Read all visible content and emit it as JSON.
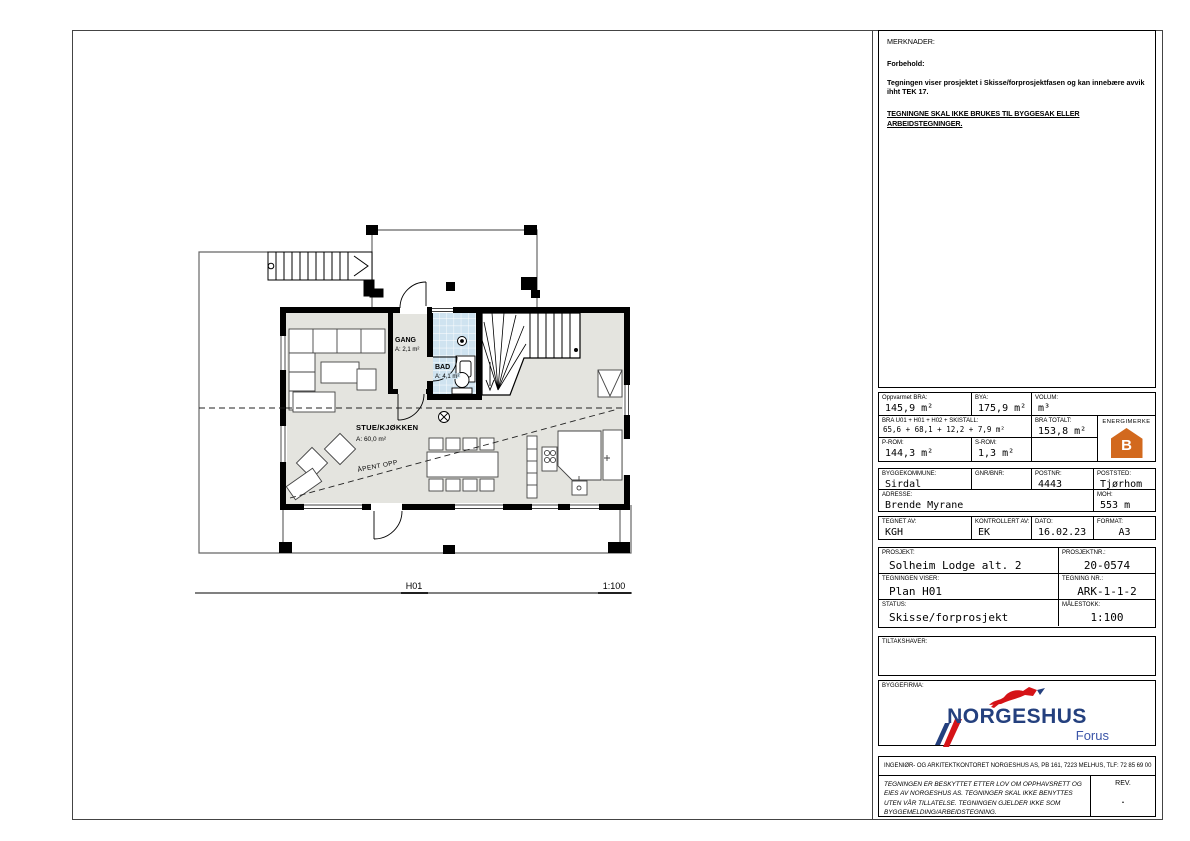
{
  "sheet": {
    "notes": {
      "title": "MERKNADER:",
      "subtitle": "Forbehold:",
      "body": "Tegningen viser prosjektet i Skisse/forprosjektfasen og kan innebære avvik ihht TEK 17.",
      "warning": "TEGNINGNE SKAL IKKE BRUKES TIL BYGGESAK ELLER ARBEIDSTEGNINGER."
    },
    "areas": {
      "oppvarmet_bra_label": "Oppvarmet BRA:",
      "oppvarmet_bra": "145,9 m²",
      "bya_label": "BYA:",
      "bya": "175,9 m²",
      "volum_label": "VOLUM:",
      "volum": "m³",
      "bra_sum_label": "BRA U01 + H01 + H02 + SKISTALL:",
      "bra_sum": "65,6 + 68,1 + 12,2 + 7,9 m²",
      "bra_totalt_label": "BRA TOTALT:",
      "bra_totalt": "153,8 m²",
      "energimerke_label": "ENERGIMERKE",
      "energimerke_grade": "B",
      "p_rom_label": "P-ROM:",
      "p_rom": "144,3 m²",
      "s_rom_label": "S-ROM:",
      "s_rom": "1,3 m²"
    },
    "site": {
      "byggekommune_label": "BYGGEKOMMUNE:",
      "byggekommune": "Sirdal",
      "gnr_bnr_label": "GNR/BNR:",
      "gnr_bnr": "",
      "postnr_label": "POSTNR:",
      "postnr": "4443",
      "poststed_label": "POSTSTED:",
      "poststed": "Tjørhom",
      "adresse_label": "ADRESSE:",
      "adresse": "Brende Myrane",
      "moh_label": "MOH:",
      "moh": "553 m"
    },
    "signoff": {
      "tegnet_av_label": "TEGNET AV:",
      "tegnet_av": "KGH",
      "kontrollert_av_label": "KONTROLLERT AV:",
      "kontrollert_av": "EK",
      "dato_label": "DATO:",
      "dato": "16.02.23",
      "format_label": "FORMAT:",
      "format": "A3"
    },
    "project": {
      "prosjekt_label": "PROSJEKT:",
      "prosjekt": "Solheim Lodge alt. 2",
      "prosjektnr_label": "PROSJEKTNR.:",
      "prosjektnr": "20-0574",
      "tegningen_viser_label": "TEGNINGEN VISER:",
      "tegningen_viser": "Plan H01",
      "tegning_nr_label": "TEGNING NR.:",
      "tegning_nr": "ARK-1-1-2",
      "status_label": "STATUS:",
      "status": "Skisse/forprosjekt",
      "malestokk_label": "MÅLESTOKK:",
      "malestokk": "1:100"
    },
    "tiltakshaver_label": "TILTAKSHAVER:",
    "byggefirma_label": "BYGGEFIRMA:",
    "logo": {
      "name": "NORGESHUS",
      "sub": "Forus"
    },
    "footer": {
      "office_line": "INGENIØR- OG ARKITEKTKONTORET NORGESHUS AS,  PB 161, 7223 MELHUS,  TLF: 72 85 69 00",
      "copyright": "TEGNINGEN ER BESKYTTET ETTER LOV OM OPPHAVSRETT OG EIES AV NORGESHUS AS. TEGNINGER SKAL IKKE BENYTTES UTEN VÅR TILLATELSE. TEGNINGEN GJELDER IKKE SOM BYGGEMELDING/ARBEIDSTEGNING.",
      "rev_label": "REV.",
      "rev_value": "."
    }
  },
  "plan": {
    "rooms": {
      "gang": {
        "name": "GANG",
        "area": "A: 2,1 m²"
      },
      "bad": {
        "name": "BAD",
        "area": "A: 4,1 m²"
      },
      "stue": {
        "name": "STUE/KJØKKEN",
        "area": "A: 60,0 m²"
      }
    },
    "open_label": "ÅPENT OPP",
    "drawing_label": "H01",
    "scale_label": "1:100"
  },
  "colors": {
    "energy_orange": "#d2691e",
    "logo_blue": "#24407e",
    "logo_red": "#d51317",
    "bath_tile": "#cfe3f0",
    "floor_gray": "#e4e4df"
  }
}
